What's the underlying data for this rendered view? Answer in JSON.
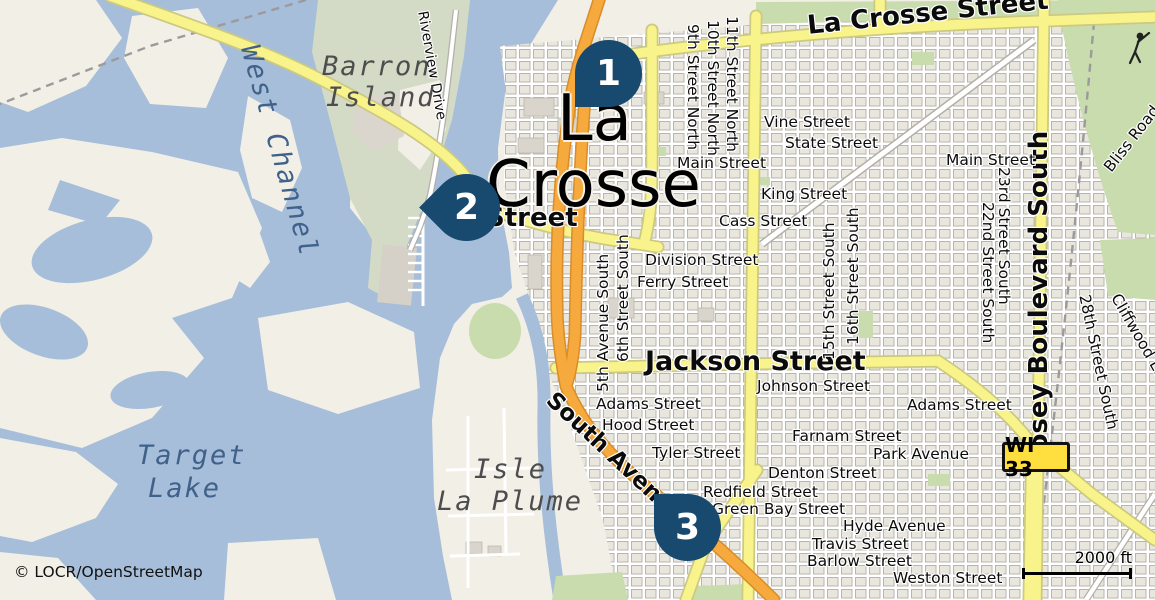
{
  "attribution": "© LOCR/OpenStreetMap",
  "scale_bar": {
    "label": "2000 ft"
  },
  "route_badge": {
    "label": "WI 33"
  },
  "colors": {
    "water": "#a6bed9",
    "land": "#f2efe7",
    "urban_block": "#e9e6de",
    "green": "#c9dcae",
    "road_yellow": "#f8f38a",
    "road_orange": "#f6aa3d",
    "marker": "#174a6e",
    "badge_yellow": "#ffdf3f"
  },
  "markers": [
    {
      "n": "1",
      "x": 575,
      "y": 40,
      "shape": "bl",
      "r": 0,
      "name": "map-pin-1"
    },
    {
      "n": "2",
      "x": 433,
      "y": 174,
      "shape": "bl",
      "r": 45,
      "name": "map-pin-2"
    },
    {
      "n": "3",
      "x": 654,
      "y": 494,
      "shape": "tl",
      "r": 0,
      "name": "map-pin-3"
    }
  ],
  "labels": [
    {
      "text": "La",
      "x": 557,
      "y": 86,
      "cls": "city",
      "name": "city-label-la"
    },
    {
      "text": "Crosse",
      "x": 486,
      "y": 152,
      "cls": "city",
      "name": "city-label-crosse"
    },
    {
      "text": "La Crosse Street",
      "x": 806,
      "y": 13,
      "r": -6,
      "cls": "mj",
      "name": "road-label-la-crosse-street"
    },
    {
      "text": "Street",
      "x": 486,
      "y": 205,
      "cls": "mj",
      "name": "road-label-street"
    },
    {
      "text": "Jackson Street",
      "x": 645,
      "y": 348,
      "size": 27,
      "cls": "mj",
      "name": "road-label-jackson-street"
    },
    {
      "text": "South Avenue",
      "x": 558,
      "y": 388,
      "r": 43,
      "size": 23,
      "cls": "mj",
      "name": "road-label-south-avenue"
    },
    {
      "text": "Losey Boulevard South",
      "x": 1026,
      "y": 468,
      "r": -90,
      "cls": "mj",
      "name": "road-label-losey-boulevard-south"
    },
    {
      "text": "Vine Street",
      "x": 764,
      "y": 114
    },
    {
      "text": "State Street",
      "x": 785,
      "y": 135
    },
    {
      "text": "Main Street",
      "x": 946,
      "y": 152
    },
    {
      "text": "Main Street",
      "x": 677,
      "y": 155
    },
    {
      "text": "King Street",
      "x": 761,
      "y": 186
    },
    {
      "text": "Cass Street",
      "x": 719,
      "y": 213
    },
    {
      "text": "Division Street",
      "x": 645,
      "y": 252
    },
    {
      "text": "Ferry Street",
      "x": 637,
      "y": 274
    },
    {
      "text": "Johnson Street",
      "x": 757,
      "y": 378
    },
    {
      "text": "Adams Street",
      "x": 596,
      "y": 396
    },
    {
      "text": "Hood Street",
      "x": 602,
      "y": 417
    },
    {
      "text": "Tyler Street",
      "x": 652,
      "y": 445
    },
    {
      "text": "Farnam Street",
      "x": 792,
      "y": 428
    },
    {
      "text": "Park Avenue",
      "x": 873,
      "y": 446
    },
    {
      "text": "Denton Street",
      "x": 768,
      "y": 465
    },
    {
      "text": "Redfield Street",
      "x": 703,
      "y": 484
    },
    {
      "text": "Green Bay Street",
      "x": 712,
      "y": 501
    },
    {
      "text": "Adams Street",
      "x": 907,
      "y": 397
    },
    {
      "text": "Hyde Avenue",
      "x": 843,
      "y": 518
    },
    {
      "text": "Travis Street",
      "x": 812,
      "y": 536
    },
    {
      "text": "Barlow Street",
      "x": 807,
      "y": 553
    },
    {
      "text": "Weston Street",
      "x": 893,
      "y": 570
    },
    {
      "text": "9th Street North",
      "x": 701,
      "y": 24,
      "r": 90
    },
    {
      "text": "10th Street North",
      "x": 721,
      "y": 20,
      "r": 90
    },
    {
      "text": "11th Street North",
      "x": 740,
      "y": 16,
      "r": 90
    },
    {
      "text": "5th Avenue South",
      "x": 595,
      "y": 392,
      "r": -90
    },
    {
      "text": "6th Street South",
      "x": 615,
      "y": 362,
      "r": -90
    },
    {
      "text": "15th Street South",
      "x": 821,
      "y": 360,
      "r": -90
    },
    {
      "text": "16th Street South",
      "x": 845,
      "y": 345,
      "r": -90
    },
    {
      "text": "23rd Street South",
      "x": 1012,
      "y": 167,
      "r": 90
    },
    {
      "text": "22nd Street South",
      "x": 996,
      "y": 202,
      "r": 90
    },
    {
      "text": "28th Street South",
      "x": 1092,
      "y": 293,
      "r": 78
    },
    {
      "text": "Cliffwood Lane",
      "x": 1122,
      "y": 291,
      "r": 60
    },
    {
      "text": "Bliss Road",
      "x": 1101,
      "y": 165,
      "r": -52
    },
    {
      "text": "Riverview Drive",
      "x": 429,
      "y": 10,
      "r": 80,
      "size": 14
    },
    {
      "text": "Barron",
      "x": 322,
      "y": 53,
      "cls": "aland",
      "name": "area-label-barron-island"
    },
    {
      "text": "Island",
      "x": 326,
      "y": 84,
      "cls": "aland",
      "name": "area-label-barron-island"
    },
    {
      "text": "West Channel",
      "x": 262,
      "y": 42,
      "r": 74,
      "cls": "awater",
      "name": "area-label-west-channel"
    },
    {
      "text": "Target",
      "x": 137,
      "y": 442,
      "cls": "awater",
      "name": "area-label-target-lake"
    },
    {
      "text": "Lake",
      "x": 148,
      "y": 475,
      "cls": "awater",
      "name": "area-label-target-lake"
    },
    {
      "text": "Isle",
      "x": 474,
      "y": 456,
      "cls": "aland",
      "name": "area-label-isle-la-plume"
    },
    {
      "text": "La Plume",
      "x": 437,
      "y": 488,
      "cls": "aland",
      "name": "area-label-isle-la-plume"
    }
  ]
}
